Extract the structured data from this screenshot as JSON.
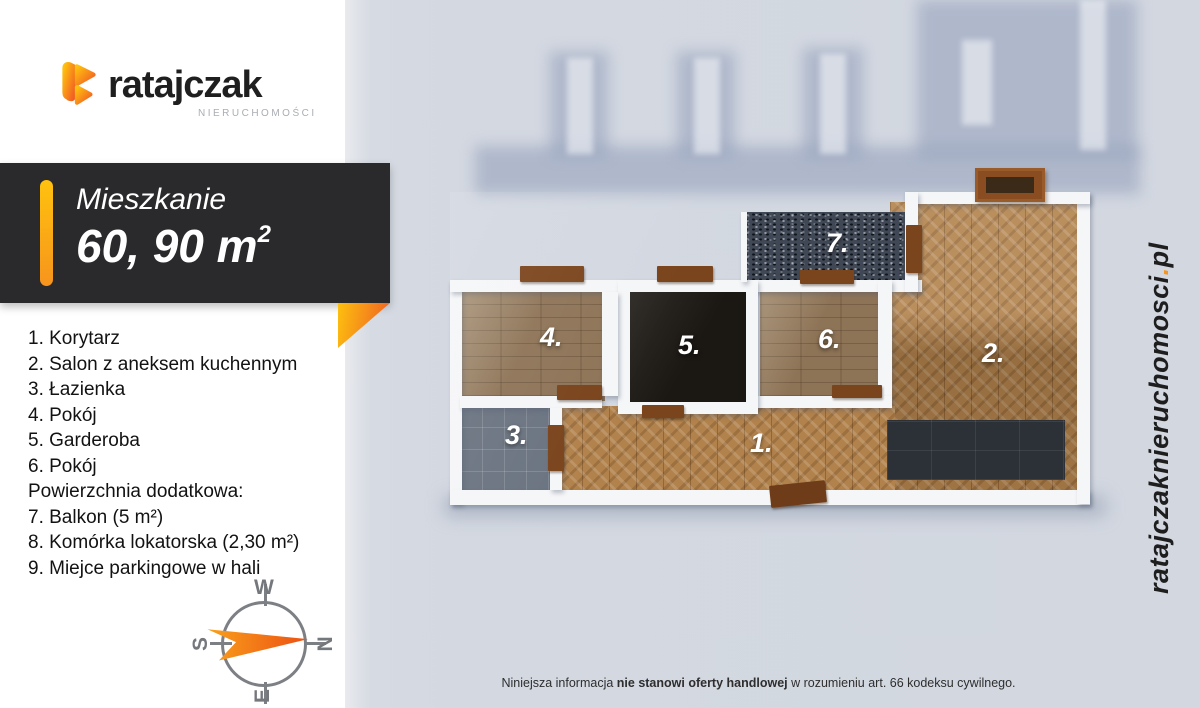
{
  "brand": {
    "name": "ratajczak",
    "subtitle": "NIERUCHOMOŚCI",
    "logo_icon": "ratajczak-ribbon-icon"
  },
  "badge": {
    "title": "Mieszkanie",
    "area_value": "60, 90 m",
    "area_sup": "2"
  },
  "room_list": {
    "items": [
      "1. Korytarz",
      "2. Salon z aneksem kuchennym",
      "3. Łazienka",
      "4. Pokój",
      "5. Garderoba",
      "6. Pokój",
      "Powierzchnia dodatkowa:",
      "7. Balkon (5 m²)",
      "8. Komórka lokatorska (2,30 m²)",
      "9. Miejce parkingowe w hali"
    ]
  },
  "compass": {
    "west": "W",
    "north": "N",
    "south": "S",
    "east": "E"
  },
  "plan": {
    "room_labels": [
      "1.",
      "2.",
      "3.",
      "4.",
      "5.",
      "6.",
      "7."
    ]
  },
  "footer": {
    "text_pre": "Niniejsza informacja ",
    "text_bold": "nie stanowi oferty handlowej",
    "text_post": " w rozumieniu art. 66 kodeksu cywilnego."
  },
  "watermark": {
    "site": "ratajczaknieruchomosci",
    "dot": ".",
    "tld": "pl"
  },
  "colors": {
    "accent_orange": "#f7941d",
    "accent_yellow": "#ffc20e",
    "badge_bg": "#2a2a2c",
    "scene_bg": "#d3d8e1",
    "wood_herringbone": "#b2824c",
    "wood_plank": "#8e7457",
    "bath_tile": "#6a7380",
    "dark_floor": "#1b1713",
    "balcony_mosaic": "#414855",
    "kitchen_tile": "#2c3037",
    "wall": "#f5f6f8"
  }
}
